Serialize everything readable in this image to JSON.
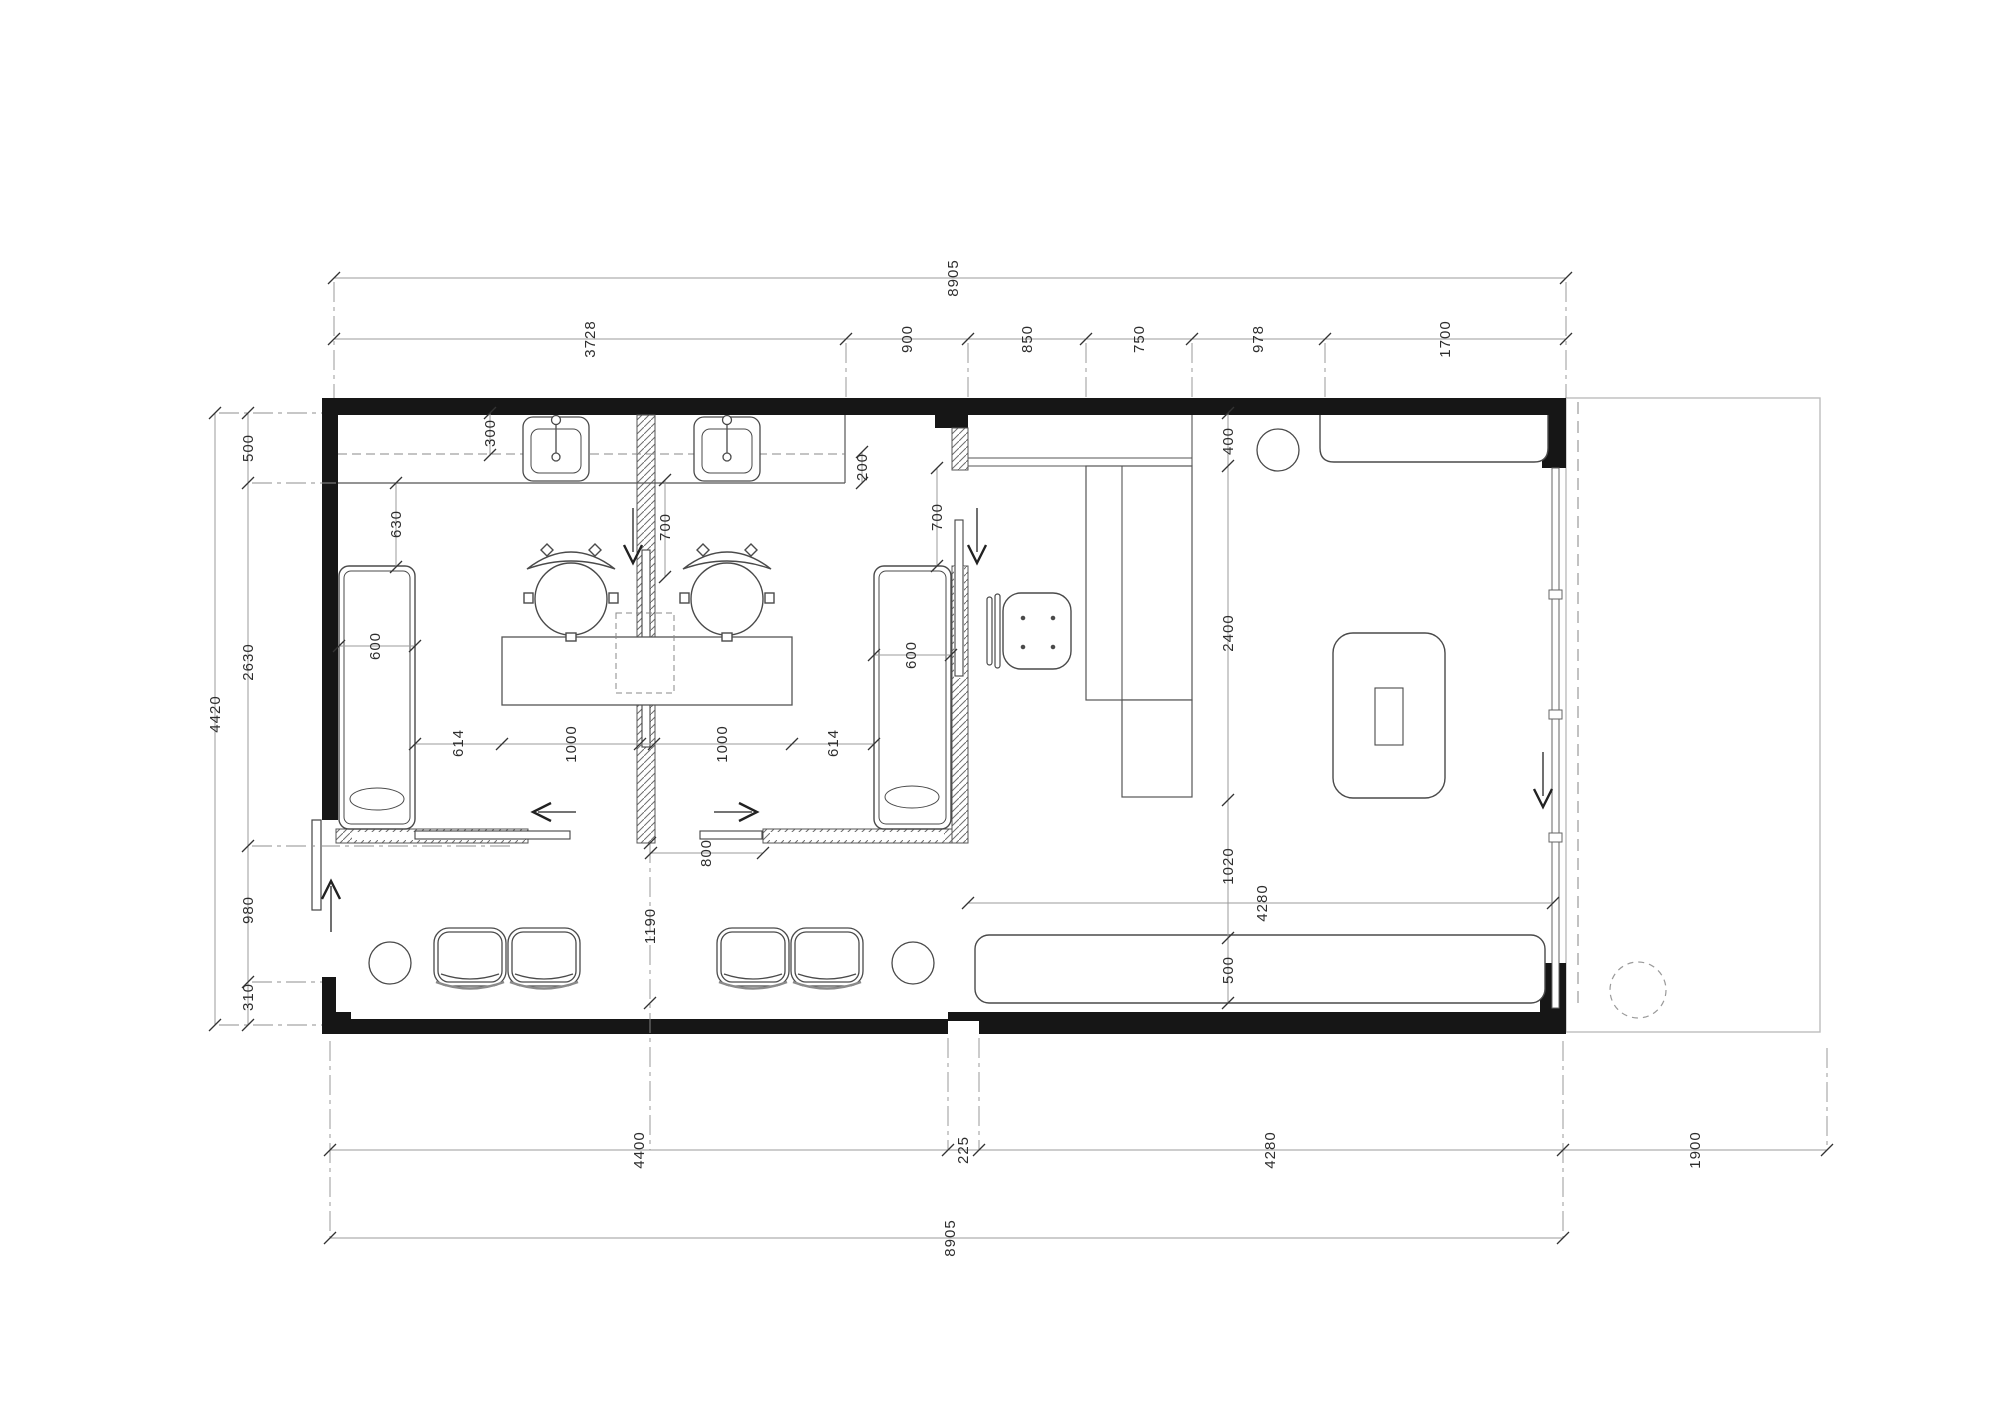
{
  "drawing": {
    "type": "floor-plan",
    "dimensions": {
      "top": {
        "overall": "8905",
        "segments": [
          "3728",
          "900",
          "850",
          "750",
          "978",
          "1700"
        ]
      },
      "left": {
        "overall": "4420",
        "segments": [
          "500",
          "2630",
          "980",
          "310"
        ]
      },
      "bottom": {
        "overall": "8905",
        "segments": [
          "4400",
          "225",
          "4280",
          "1900"
        ]
      },
      "interior": {
        "shelf_depth": "300",
        "counter_edge": "200",
        "bed_clearance": "630",
        "bed_width_left": "600",
        "door_left": "700",
        "door_right": "700",
        "aisle_left": "614",
        "desk_left": "1000",
        "desk_right": "1000",
        "aisle_right": "614",
        "bed_width_right": "600",
        "slide_opening": "800",
        "corridor": "1190",
        "reception_clearance": "400",
        "reception_run": "2400",
        "walkway": "1020",
        "bench_depth": "500",
        "bench_run": "4280"
      }
    },
    "colors": {
      "wall": "#161616",
      "line": "#4a4a4a",
      "dim_line": "#9b9b9b",
      "dim_text": "#2e2e2e",
      "light": "#bdbdbd"
    }
  }
}
